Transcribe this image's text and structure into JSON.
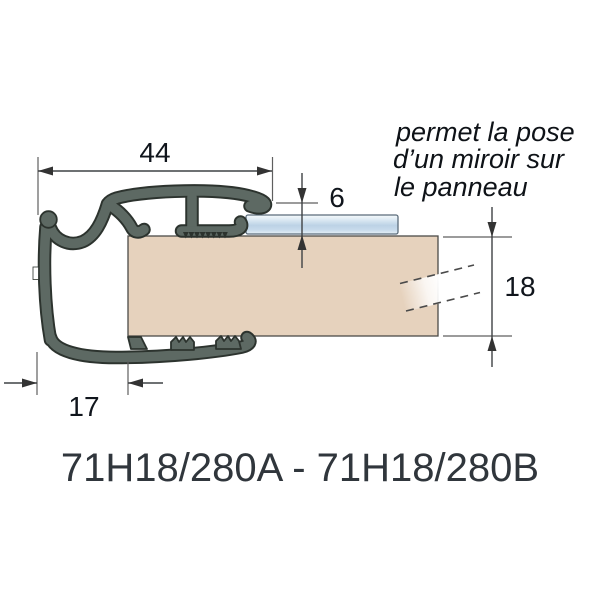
{
  "diagram": {
    "annotation": {
      "lines": [
        "permet la pose",
        "d’un miroir sur",
        "le panneau"
      ]
    },
    "dimensions": {
      "top_width": "44",
      "mirror_recess": "6",
      "panel_thickness": "18",
      "bottom_width": "17"
    },
    "product_code": "71H18/280A - 71H18/280B",
    "colors": {
      "profile_fill": "#5d6963",
      "profile_outline": "#2c332e",
      "panel_fill": "#e6d2bd",
      "panel_outline": "#4c4c48",
      "mirror_outline": "#5a6b7a",
      "dimension_line": "#3f4245",
      "label_text": "#10151c",
      "annotation_text": "#0e1217",
      "product_code_text": "#30363c"
    }
  }
}
